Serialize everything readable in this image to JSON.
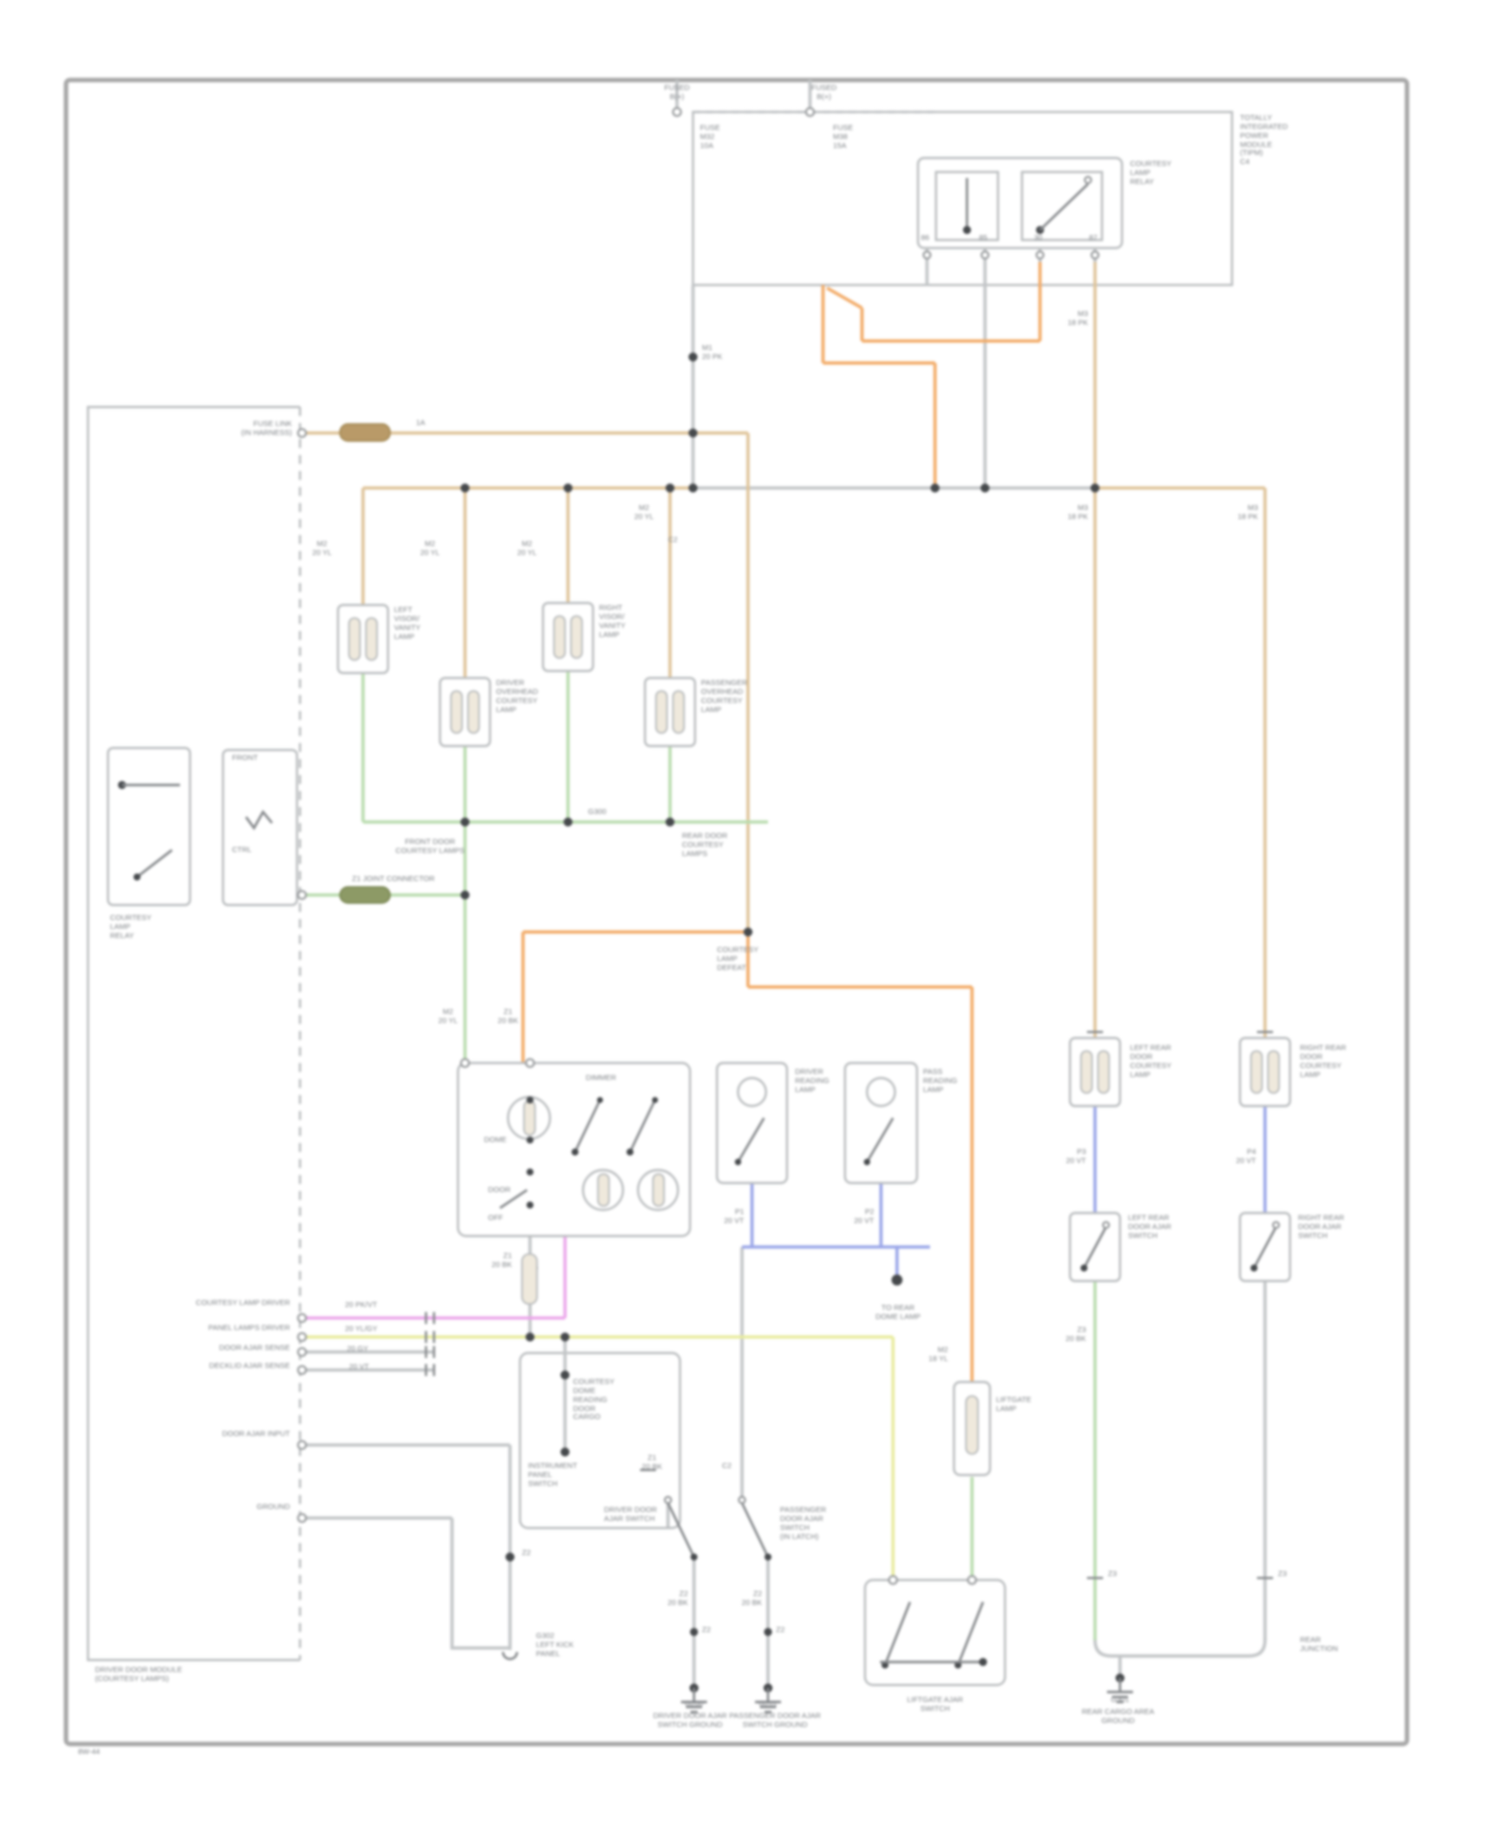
{
  "palette": {
    "tan": "#dfc49a",
    "orange": "#f2aa66",
    "green": "#b9dcae",
    "gray": "#c2c5c7",
    "darkgray": "#9fa2a5",
    "blue": "#9aa6e8",
    "magenta": "#eba6ea",
    "yellow": "#e8ec9e",
    "olive": "#8d9a66",
    "darktan": "#b99a68",
    "box": "#b9bcbe",
    "frame": "#a8a8a8",
    "text": "#7e8286"
  },
  "page": {
    "footer": "8W-44"
  },
  "labels": [
    {
      "name": "fused-b1",
      "x": 677,
      "y": 84,
      "align": "center",
      "lines": [
        "FUSED",
        "B(+)"
      ]
    },
    {
      "name": "fused-b2",
      "x": 824,
      "y": 84,
      "align": "center",
      "lines": [
        "FUSED",
        "B(+)"
      ]
    },
    {
      "name": "fuse-1",
      "x": 700,
      "y": 124,
      "align": "left",
      "lines": [
        "FUSE",
        "M32",
        "10A"
      ]
    },
    {
      "name": "fuse-2",
      "x": 833,
      "y": 124,
      "align": "left",
      "lines": [
        "FUSE",
        "M38",
        "15A"
      ]
    },
    {
      "name": "tipm-label",
      "x": 1240,
      "y": 114,
      "align": "left",
      "lines": [
        "TOTALLY",
        "INTEGRATED",
        "POWER",
        "MODULE",
        "(TIPM)",
        "C4"
      ]
    },
    {
      "name": "relay-label",
      "x": 1130,
      "y": 160,
      "align": "left",
      "lines": [
        "COURTESY",
        "LAMP",
        "RELAY"
      ]
    },
    {
      "name": "pin-86",
      "x": 921,
      "y": 234,
      "align": "left",
      "lines": [
        "86"
      ]
    },
    {
      "name": "pin-85",
      "x": 979,
      "y": 234,
      "align": "left",
      "lines": [
        "85"
      ]
    },
    {
      "name": "pin-30",
      "x": 1034,
      "y": 234,
      "align": "left",
      "lines": [
        "30"
      ]
    },
    {
      "name": "pin-87",
      "x": 1089,
      "y": 234,
      "align": "left",
      "lines": [
        "87"
      ]
    },
    {
      "name": "wire-m1",
      "x": 702,
      "y": 344,
      "align": "left",
      "lines": [
        "M1",
        "20 PK"
      ]
    },
    {
      "name": "fuse-link",
      "x": 292,
      "y": 420,
      "align": "right",
      "lines": [
        "FUSE LINK",
        "(IN HARNESS)"
      ]
    },
    {
      "name": "link-1a",
      "x": 416,
      "y": 419,
      "align": "left",
      "lines": [
        "1A"
      ]
    },
    {
      "name": "conn-a",
      "x": 322,
      "y": 540,
      "align": "center",
      "lines": [
        "M2",
        "20 YL"
      ]
    },
    {
      "name": "conn-b",
      "x": 430,
      "y": 540,
      "align": "center",
      "lines": [
        "M2",
        "20 YL"
      ]
    },
    {
      "name": "conn-c",
      "x": 527,
      "y": 540,
      "align": "center",
      "lines": [
        "M2",
        "20 YL"
      ]
    },
    {
      "name": "conn-d",
      "x": 644,
      "y": 504,
      "align": "center",
      "lines": [
        "M2",
        "20 YL"
      ]
    },
    {
      "name": "conn-e",
      "x": 668,
      "y": 536,
      "align": "left",
      "lines": [
        "C2"
      ]
    },
    {
      "name": "conn-r1",
      "x": 1088,
      "y": 310,
      "align": "right",
      "lines": [
        "M3",
        "18 PK"
      ]
    },
    {
      "name": "conn-r2",
      "x": 1088,
      "y": 504,
      "align": "right",
      "lines": [
        "M3",
        "18 PK"
      ]
    },
    {
      "name": "conn-r3",
      "x": 1258,
      "y": 504,
      "align": "right",
      "lines": [
        "M3",
        "18 PK"
      ]
    },
    {
      "name": "lamp1-label",
      "x": 394,
      "y": 606,
      "align": "left",
      "lines": [
        "LEFT",
        "VISOR/",
        "VANITY",
        "LAMP"
      ]
    },
    {
      "name": "lamp2-label",
      "x": 496,
      "y": 679,
      "align": "left",
      "lines": [
        "DRIVER",
        "OVERHEAD",
        "COURTESY",
        "LAMP"
      ]
    },
    {
      "name": "lamp3-label",
      "x": 599,
      "y": 604,
      "align": "left",
      "lines": [
        "RIGHT",
        "VISOR/",
        "VANITY",
        "LAMP"
      ]
    },
    {
      "name": "lamp4-label",
      "x": 701,
      "y": 679,
      "align": "left",
      "lines": [
        "PASSENGER",
        "OVERHEAD",
        "COURTESY",
        "LAMP"
      ]
    },
    {
      "name": "g300-label",
      "x": 588,
      "y": 808,
      "align": "left",
      "lines": [
        "G300"
      ]
    },
    {
      "name": "gbus-center",
      "x": 430,
      "y": 838,
      "align": "center",
      "lines": [
        "FRONT DOOR",
        "COURTESY LAMPS"
      ]
    },
    {
      "name": "gbus-right",
      "x": 682,
      "y": 832,
      "align": "left",
      "lines": [
        "REAR DOOR",
        "COURTESY",
        "LAMPS"
      ]
    },
    {
      "name": "zbus-pill-label",
      "x": 352,
      "y": 875,
      "align": "left",
      "lines": [
        "Z1 JOINT CONNECTOR"
      ]
    },
    {
      "name": "defeat-label",
      "x": 717,
      "y": 946,
      "align": "left",
      "lines": [
        "COURTESY",
        "LAMP",
        "DEFEAT"
      ]
    },
    {
      "name": "conn-g1",
      "x": 448,
      "y": 1008,
      "align": "center",
      "lines": [
        "M2",
        "20 YL"
      ]
    },
    {
      "name": "conn-g2",
      "x": 508,
      "y": 1008,
      "align": "center",
      "lines": [
        "Z1",
        "20 BK"
      ]
    },
    {
      "name": "dimmer-label",
      "x": 601,
      "y": 1074,
      "align": "center",
      "lines": [
        "DIMMER"
      ]
    },
    {
      "name": "dome-label",
      "x": 484,
      "y": 1136,
      "align": "left",
      "lines": [
        "DOME"
      ]
    },
    {
      "name": "door-label",
      "x": 488,
      "y": 1186,
      "align": "left",
      "lines": [
        "DOOR"
      ]
    },
    {
      "name": "off-label",
      "x": 488,
      "y": 1214,
      "align": "left",
      "lines": [
        "OFF"
      ]
    },
    {
      "name": "box2-label",
      "x": 795,
      "y": 1068,
      "align": "left",
      "lines": [
        "DRIVER",
        "READING",
        "LAMP"
      ]
    },
    {
      "name": "box3-label",
      "x": 923,
      "y": 1068,
      "align": "left",
      "lines": [
        "PASS",
        "READING",
        "LAMP"
      ]
    },
    {
      "name": "b2-wire",
      "x": 744,
      "y": 1208,
      "align": "right",
      "lines": [
        "P1",
        "20 VT"
      ]
    },
    {
      "name": "b3-wire",
      "x": 874,
      "y": 1208,
      "align": "right",
      "lines": [
        "P2",
        "20 VT"
      ]
    },
    {
      "name": "to-rear-dome",
      "x": 898,
      "y": 1304,
      "align": "center",
      "lines": [
        "TO REAR",
        "DOME LAMP"
      ]
    },
    {
      "name": "z1-below-box",
      "x": 512,
      "y": 1252,
      "align": "right",
      "lines": [
        "Z1",
        "20 BK"
      ]
    },
    {
      "name": "left-row1",
      "x": 290,
      "y": 1299,
      "align": "right",
      "lines": [
        "COURTESY LAMP DRIVER"
      ]
    },
    {
      "name": "left-row2",
      "x": 290,
      "y": 1324,
      "align": "right",
      "lines": [
        "PANEL LAMPS DRIVER"
      ]
    },
    {
      "name": "left-row3",
      "x": 290,
      "y": 1344,
      "align": "right",
      "lines": [
        "DOOR AJAR SENSE"
      ]
    },
    {
      "name": "left-row4",
      "x": 290,
      "y": 1362,
      "align": "right",
      "lines": [
        "DECKLID AJAR SENSE"
      ]
    },
    {
      "name": "wr1",
      "x": 345,
      "y": 1301,
      "align": "left",
      "lines": [
        "20 PK/VT"
      ]
    },
    {
      "name": "wr2",
      "x": 345,
      "y": 1325,
      "align": "left",
      "lines": [
        "20 YL/GY"
      ]
    },
    {
      "name": "wr3",
      "x": 347,
      "y": 1345,
      "align": "left",
      "lines": [
        "20 GY"
      ]
    },
    {
      "name": "wr4",
      "x": 349,
      "y": 1363,
      "align": "left",
      "lines": [
        "20 VT"
      ]
    },
    {
      "name": "left-row5",
      "x": 290,
      "y": 1430,
      "align": "right",
      "lines": [
        "DOOR AJAR INPUT"
      ]
    },
    {
      "name": "left-row6",
      "x": 290,
      "y": 1503,
      "align": "right",
      "lines": [
        "GROUND"
      ]
    },
    {
      "name": "z2-dot",
      "x": 522,
      "y": 1549,
      "align": "left",
      "lines": [
        "Z2"
      ]
    },
    {
      "name": "g302-label",
      "x": 536,
      "y": 1632,
      "align": "left",
      "lines": [
        "G302",
        "LEFT KICK",
        "PANEL"
      ]
    },
    {
      "name": "module-bottom-label",
      "x": 95,
      "y": 1666,
      "align": "left",
      "lines": [
        "DRIVER DOOR MODULE",
        "(COURTESY LAMPS)"
      ]
    },
    {
      "name": "botbox-rows",
      "x": 573,
      "y": 1378,
      "align": "left",
      "lines": [
        "COURTESY",
        "DOME",
        "READING",
        "DOOR",
        "CARGO"
      ]
    },
    {
      "name": "botbox-left",
      "x": 528,
      "y": 1462,
      "align": "left",
      "lines": [
        "INSTRUMENT",
        "PANEL",
        "SWITCH"
      ]
    },
    {
      "name": "conn-z648",
      "x": 652,
      "y": 1454,
      "align": "center",
      "lines": [
        "Z1",
        "20 BK"
      ]
    },
    {
      "name": "conn-c720",
      "x": 722,
      "y": 1462,
      "align": "left",
      "lines": [
        "C2"
      ]
    },
    {
      "name": "sw1-label",
      "x": 604,
      "y": 1506,
      "align": "left",
      "lines": [
        "DRIVER DOOR",
        "AJAR SWITCH"
      ]
    },
    {
      "name": "sw2-label",
      "x": 780,
      "y": 1506,
      "align": "left",
      "lines": [
        "PASSENGER",
        "DOOR AJAR",
        "SWITCH",
        "(IN LATCH)"
      ]
    },
    {
      "name": "sw1-wire",
      "x": 688,
      "y": 1590,
      "align": "right",
      "lines": [
        "Z2",
        "20 BK"
      ]
    },
    {
      "name": "sw2-wire",
      "x": 762,
      "y": 1590,
      "align": "right",
      "lines": [
        "Z2",
        "20 BK"
      ]
    },
    {
      "name": "sw1-z2",
      "x": 702,
      "y": 1626,
      "align": "left",
      "lines": [
        "Z2"
      ]
    },
    {
      "name": "sw2-z2",
      "x": 776,
      "y": 1626,
      "align": "left",
      "lines": [
        "Z2"
      ]
    },
    {
      "name": "g200-label",
      "x": 694,
      "y": 1700,
      "align": "center",
      "lines": [
        "G200"
      ]
    },
    {
      "name": "g200-name",
      "x": 690,
      "y": 1712,
      "align": "center",
      "lines": [
        "DRIVER DOOR AJAR",
        "SWITCH GROUND"
      ]
    },
    {
      "name": "g201-label",
      "x": 768,
      "y": 1700,
      "align": "center",
      "lines": [
        "G201"
      ]
    },
    {
      "name": "g201-name",
      "x": 775,
      "y": 1712,
      "align": "center",
      "lines": [
        "PASSENGER DOOR AJAR",
        "SWITCH GROUND"
      ]
    },
    {
      "name": "liftgate-lamp-label",
      "x": 996,
      "y": 1396,
      "align": "left",
      "lines": [
        "LIFTGATE",
        "LAMP"
      ]
    },
    {
      "name": "orange-wire-label",
      "x": 948,
      "y": 1346,
      "align": "right",
      "lines": [
        "M2",
        "18 YL"
      ]
    },
    {
      "name": "liftgate-switch-label",
      "x": 935,
      "y": 1696,
      "align": "center",
      "lines": [
        "LIFTGATE AJAR",
        "SWITCH"
      ]
    },
    {
      "name": "lamp5-label",
      "x": 1130,
      "y": 1044,
      "align": "left",
      "lines": [
        "LEFT REAR",
        "DOOR",
        "COURTESY",
        "LAMP"
      ]
    },
    {
      "name": "lamp6-label",
      "x": 1300,
      "y": 1044,
      "align": "left",
      "lines": [
        "RIGHT REAR",
        "DOOR",
        "COURTESY",
        "LAMP"
      ]
    },
    {
      "name": "sw5-label",
      "x": 1128,
      "y": 1214,
      "align": "left",
      "lines": [
        "LEFT REAR",
        "DOOR AJAR",
        "SWITCH"
      ]
    },
    {
      "name": "sw6-label",
      "x": 1298,
      "y": 1214,
      "align": "left",
      "lines": [
        "RIGHT REAR",
        "DOOR AJAR",
        "SWITCH"
      ]
    },
    {
      "name": "b5-wire",
      "x": 1086,
      "y": 1148,
      "align": "right",
      "lines": [
        "P3",
        "20 VT"
      ]
    },
    {
      "name": "b6-wire",
      "x": 1256,
      "y": 1148,
      "align": "right",
      "lines": [
        "P4",
        "20 VT"
      ]
    },
    {
      "name": "g5-wire",
      "x": 1086,
      "y": 1326,
      "align": "right",
      "lines": [
        "Z3",
        "20 BK"
      ]
    },
    {
      "name": "t5-tick",
      "x": 1108,
      "y": 1570,
      "align": "left",
      "lines": [
        "Z3"
      ]
    },
    {
      "name": "t6-tick",
      "x": 1278,
      "y": 1570,
      "align": "left",
      "lines": [
        "Z3"
      ]
    },
    {
      "name": "rear-bus-label",
      "x": 1300,
      "y": 1636,
      "align": "left",
      "lines": [
        "REAR",
        "JUNCTION"
      ]
    },
    {
      "name": "g301-label",
      "x": 1120,
      "y": 1696,
      "align": "center",
      "lines": [
        "G301"
      ]
    },
    {
      "name": "g301-name",
      "x": 1118,
      "y": 1708,
      "align": "center",
      "lines": [
        "REAR CARGO AREA",
        "GROUND"
      ]
    },
    {
      "name": "relay2-row1",
      "x": 232,
      "y": 754,
      "align": "left",
      "lines": [
        "FRONT"
      ]
    },
    {
      "name": "relay2-row2",
      "x": 232,
      "y": 846,
      "align": "left",
      "lines": [
        "CTRL"
      ]
    },
    {
      "name": "left-relay-label",
      "x": 110,
      "y": 914,
      "align": "left",
      "lines": [
        "COURTESY",
        "LAMP",
        "RELAY"
      ]
    },
    {
      "name": "footer-code",
      "x": 78,
      "y": 1748,
      "align": "left",
      "lines": [
        "8W-44"
      ]
    }
  ]
}
